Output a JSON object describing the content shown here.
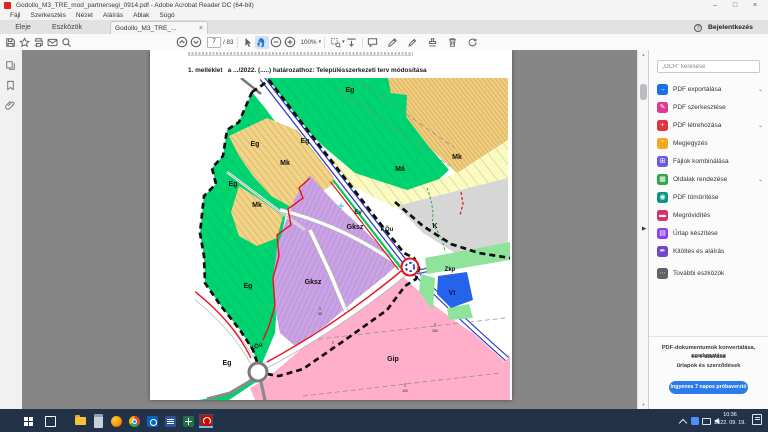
{
  "window": {
    "title": "Godollo_M3_TRE_mod_partnersegi_0914.pdf - Adobe Acrobat Reader DC (64-bit)",
    "minimize": "–",
    "maximize": "□",
    "close": "×"
  },
  "menu": {
    "items": [
      "Fájl",
      "Szerkesztés",
      "Nézet",
      "Aláírás",
      "Ablak",
      "Súgó"
    ]
  },
  "tabs": {
    "home": "Eleje",
    "tools": "Eszközök",
    "doc": "Godollo_M3_TRE_...",
    "doc_close": "×"
  },
  "account": {
    "help": "?",
    "signin": "Bejelentkezés"
  },
  "toolbar": {
    "page_current": "7",
    "page_total": "/ 83",
    "zoom_value": "100%",
    "zoom_caret": "▾",
    "marquee_caret": "▾"
  },
  "document": {
    "heading": "1. melléklet   a .../2022. (.....) határozathoz: Településszerkezeti terv módosítása"
  },
  "map": {
    "labels": [
      {
        "text": "Eg"
      },
      {
        "text": "Eg"
      },
      {
        "text": "Eg"
      },
      {
        "text": "Eg"
      },
      {
        "text": "Eg"
      },
      {
        "text": "Eg"
      },
      {
        "text": "Mk"
      },
      {
        "text": "Mk"
      },
      {
        "text": "Mk"
      },
      {
        "text": "Má"
      },
      {
        "text": "K"
      },
      {
        "text": "Ev"
      },
      {
        "text": "Gksz"
      },
      {
        "text": "KÖu"
      },
      {
        "text": "Gksz"
      },
      {
        "text": "KÖu"
      },
      {
        "text": "Zkp"
      },
      {
        "text": "Vt"
      },
      {
        "text": "Gip"
      },
      {
        "text": "250"
      },
      {
        "text": "100"
      },
      {
        "text": "60"
      },
      {
        "text": "60"
      }
    ],
    "colors": {
      "forest_green": "#00d470",
      "orchard_tan": "#f2d488",
      "farmland_yellow": "#fafac2",
      "special_gray": "#d6d6d6",
      "commercial_purple": "#c9a3e3",
      "industrial_pink": "#ffafc9",
      "town_center_blue": "#2563eb",
      "park_green": "#8fe39b",
      "road_blue": "#2334c0",
      "boundary_red": "#e8111a",
      "boundary_black": "#0d0d0d",
      "eco_green": "#00c850"
    }
  },
  "sidebar_right": {
    "search_placeholder": "„OCR” keresése",
    "tools": [
      {
        "label": "PDF exportálása",
        "glyph": "→",
        "chevron": "⌄",
        "color": "#1473e6"
      },
      {
        "label": "PDF szerkesztése",
        "glyph": "✎",
        "chevron": "",
        "color": "#e03a8c"
      },
      {
        "label": "PDF létrehozása",
        "glyph": "+",
        "chevron": "⌄",
        "color": "#e4343a"
      },
      {
        "label": "Megjegyzés",
        "glyph": "“",
        "chevron": "",
        "color": "#f5a623"
      },
      {
        "label": "Fájlok kombinálása",
        "glyph": "⊞",
        "chevron": "",
        "color": "#6d5be8"
      },
      {
        "label": "Oldalak rendezése",
        "glyph": "▦",
        "chevron": "⌄",
        "color": "#30a64a"
      },
      {
        "label": "PDF tömörítése",
        "glyph": "◉",
        "chevron": "",
        "color": "#0d9488"
      },
      {
        "label": "Megrövidítés",
        "glyph": "▬",
        "chevron": "",
        "color": "#d6336c"
      },
      {
        "label": "Űrlap készítése",
        "glyph": "▤",
        "chevron": "",
        "color": "#8a3ffc"
      },
      {
        "label": "Kitöltés és aláírás",
        "glyph": "✒",
        "chevron": "",
        "color": "#7048c8"
      },
      {
        "label": "További eszközök",
        "glyph": "⋯",
        "chevron": "",
        "color": "#5f6368"
      }
    ],
    "promo_line1": "PDF-dokumentumok konvertálása, szerkesztése",
    "promo_line2": "és e-aláírása",
    "promo_line3": "űrlapok és szerződések",
    "cta": "Ingyenes 7 napos próbaverzió"
  },
  "taskbar": {
    "time": "10:36",
    "date": "2022. 09. 19."
  }
}
